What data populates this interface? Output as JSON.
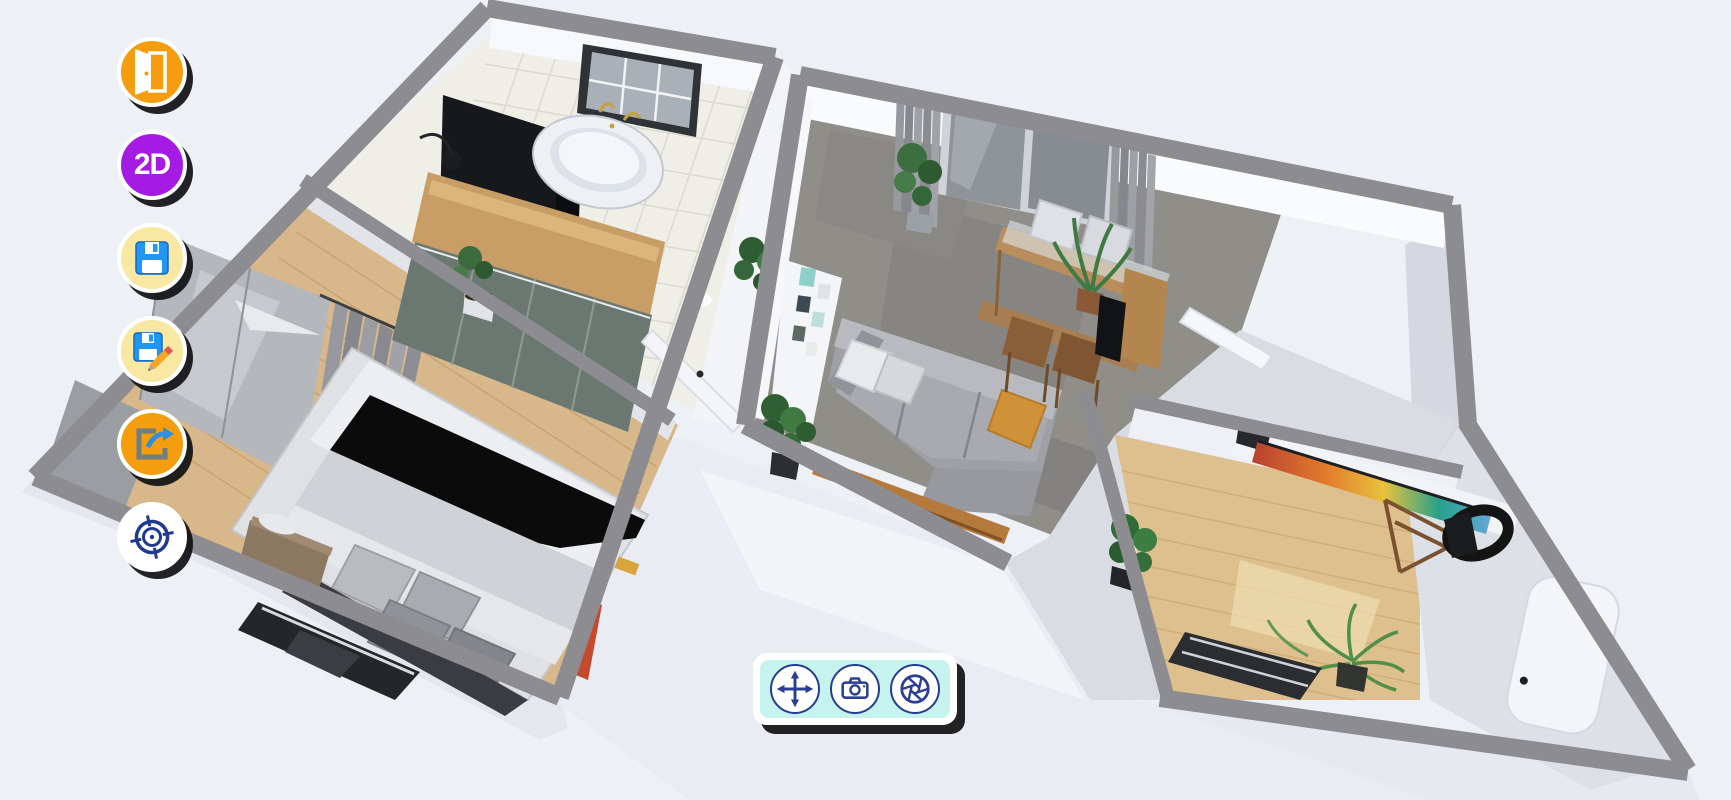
{
  "app": {
    "name": "3d-home-planner",
    "view_mode": "3D dollhouse floor plan"
  },
  "colors": {
    "bg": "#edf0f4",
    "wall": "#8c8c91",
    "accent-orange": "#f49d0e",
    "accent-purple": "#a51be4",
    "accent-paleyellow": "#f8e8a2",
    "navy": "#263d91",
    "toolbar-cyan": "#c7f3ef",
    "blue": "#2196f3"
  },
  "left_toolbar": {
    "buttons": [
      {
        "name": "door",
        "icon": "door-icon",
        "bg": "#f49d0e",
        "label": ""
      },
      {
        "name": "2d-view",
        "icon": "",
        "bg": "#a51be4",
        "label": "2D"
      },
      {
        "name": "save",
        "icon": "floppy-disk-icon",
        "bg": "#f8e8a2",
        "label": ""
      },
      {
        "name": "save-as",
        "icon": "floppy-disk-pencil-icon",
        "bg": "#f8e8a2",
        "label": ""
      },
      {
        "name": "export",
        "icon": "share-arrow-icon",
        "bg": "#f49d0e",
        "label": ""
      },
      {
        "name": "center-view",
        "icon": "crosshair-target-icon",
        "bg": "#ffffff",
        "label": ""
      }
    ]
  },
  "bottom_toolbar": {
    "bg": "#c7f3ef",
    "buttons": [
      {
        "name": "move",
        "icon": "move-arrows-icon"
      },
      {
        "name": "snapshot",
        "icon": "camera-icon"
      },
      {
        "name": "render",
        "icon": "aperture-icon"
      }
    ]
  },
  "scene": {
    "type": "3d-floorplan-render",
    "wall_color": "#8c8c91",
    "rooms": [
      {
        "name": "bathroom",
        "floor": "white-tile",
        "items": [
          "freestanding-bathtub",
          "window",
          "black-cabinet",
          "floor-lamp",
          "plant"
        ]
      },
      {
        "name": "bedroom",
        "floor": "light-wood",
        "items": [
          "double-bed",
          "black-blanket",
          "pillows",
          "wardrobe",
          "glass-wardrobe",
          "curtains",
          "nightstand",
          "dark-rug",
          "red-ladder"
        ]
      },
      {
        "name": "living-dining-room",
        "floor": "gray-tile",
        "items": [
          "sofa",
          "white-cushions",
          "orange-cushion",
          "console-bench",
          "dining-table",
          "chairs",
          "sliding-glass-door",
          "curtains",
          "plants",
          "gallery-frames",
          "tv-cabinet"
        ]
      },
      {
        "name": "hallway",
        "floor": "pale-gray",
        "items": [
          "open-white-door",
          "doormat",
          "plant"
        ]
      },
      {
        "name": "office",
        "floor": "light-wood",
        "items": [
          "colorful-wall-art",
          "telescope",
          "cactus",
          "palm-plant"
        ]
      },
      {
        "name": "small-bathroom",
        "floor": "pale-gray",
        "items": [
          "bathtub"
        ]
      }
    ]
  }
}
